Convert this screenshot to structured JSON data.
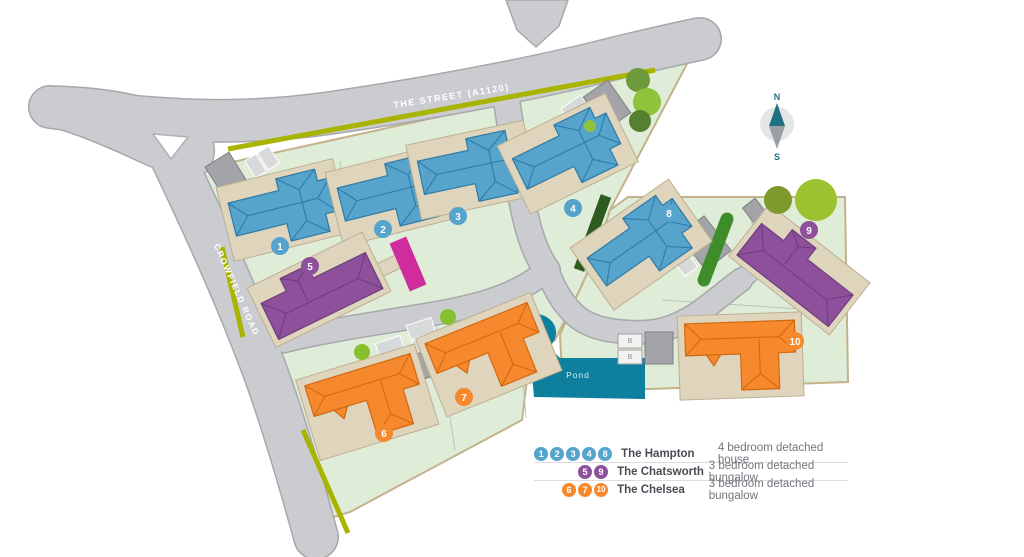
{
  "map": {
    "road_labels": {
      "the_street": "THE STREET (A1120)",
      "crowfield_road": "CROWFIELD ROAD"
    },
    "pond_label": "Pond",
    "compass": {
      "north": "N",
      "south": "S"
    },
    "store_label": "B",
    "plots": [
      {
        "number": "1",
        "type": "The Hampton"
      },
      {
        "number": "2",
        "type": "The Hampton"
      },
      {
        "number": "3",
        "type": "The Hampton"
      },
      {
        "number": "4",
        "type": "The Hampton"
      },
      {
        "number": "5",
        "type": "The Chatsworth"
      },
      {
        "number": "6",
        "type": "The Chelsea"
      },
      {
        "number": "7",
        "type": "The Chelsea"
      },
      {
        "number": "8",
        "type": "The Hampton"
      },
      {
        "number": "9",
        "type": "The Chatsworth"
      },
      {
        "number": "10",
        "type": "The Chelsea"
      }
    ]
  },
  "legend": {
    "rows": [
      {
        "plots": [
          "1",
          "2",
          "3",
          "4",
          "8"
        ],
        "name": "The Hampton",
        "description": "4 bedroom detached house",
        "color": "#56a4cc"
      },
      {
        "plots": [
          "5",
          "9"
        ],
        "name": "The Chatsworth",
        "description": "3 bedroom detached bungalow",
        "color": "#8e4f9b"
      },
      {
        "plots": [
          "6",
          "7",
          "10"
        ],
        "name": "The Chelsea",
        "description": "3 bedroom detached bungalow",
        "color": "#f6892d"
      }
    ]
  },
  "colors": {
    "hampton": "#56a4cc",
    "chatsworth": "#8e4f9b",
    "chelsea": "#f6892d",
    "pond": "#0f7f9e",
    "road": "#cacccf",
    "verge": "#a9b400"
  }
}
